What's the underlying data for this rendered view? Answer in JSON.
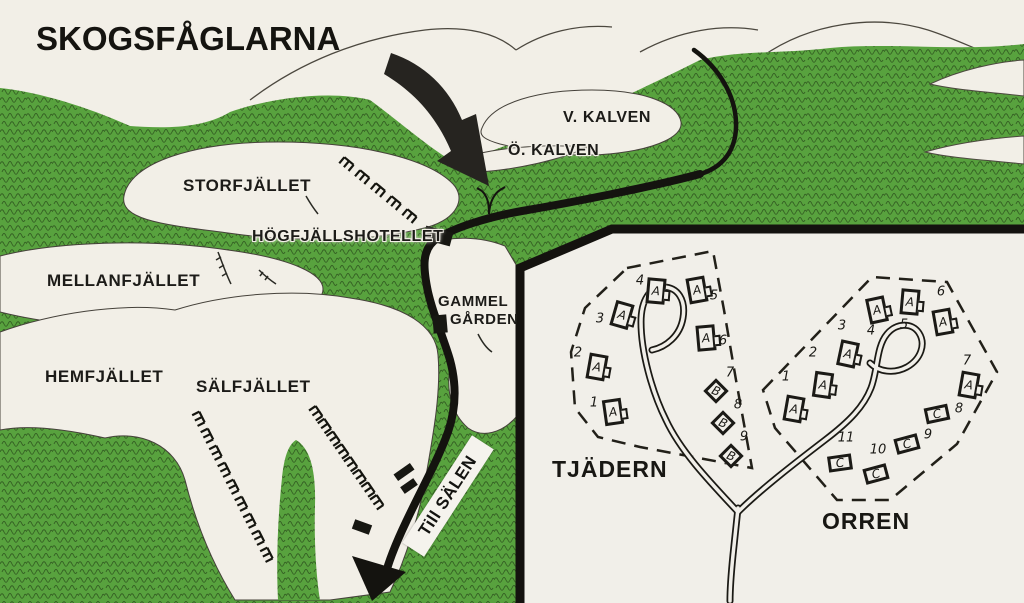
{
  "title": "SKOGSFÅGLARNA",
  "colors": {
    "forest_green": "#58a23e",
    "paper": "#f2efe7",
    "inset_paper": "#f1efe9",
    "ink": "#1c1b18"
  },
  "map_labels": {
    "storfjallet": "STORFJÄLLET",
    "v_kalven": "V. KALVEN",
    "o_kalven": "Ö. KALVEN",
    "hogfjallshotellet": "HÖGFJÄLLSHOTELLET",
    "mellanfjallet": "MELLANFJÄLLET",
    "gammel": "GAMMEL",
    "garden": "GÅRDEN",
    "hemfjallet": "HEMFJÄLLET",
    "salfjallet": "SÄLFJÄLLET",
    "till_salen": "Till SÄLEN"
  },
  "inset": {
    "areas": [
      {
        "name": "TJÄDERN",
        "cabins": [
          {
            "n": "1",
            "type": "A",
            "x": 613,
            "y": 412,
            "rot": -8,
            "nx": 594,
            "ny": 403
          },
          {
            "n": "2",
            "type": "A",
            "x": 597,
            "y": 367,
            "rot": 10,
            "nx": 578,
            "ny": 353
          },
          {
            "n": "3",
            "type": "A",
            "x": 622,
            "y": 315,
            "rot": 16,
            "nx": 600,
            "ny": 319
          },
          {
            "n": "4",
            "type": "A",
            "x": 656,
            "y": 291,
            "rot": 5,
            "nx": 640,
            "ny": 281
          },
          {
            "n": "5",
            "type": "A",
            "x": 697,
            "y": 290,
            "rot": -10,
            "nx": 714,
            "ny": 296
          },
          {
            "n": "6",
            "type": "A",
            "x": 706,
            "y": 338,
            "rot": -5,
            "nx": 723,
            "ny": 341
          },
          {
            "n": "7",
            "type": "B",
            "x": 716,
            "y": 391,
            "rot": 45,
            "nx": 730,
            "ny": 373
          },
          {
            "n": "8",
            "type": "B",
            "x": 723,
            "y": 423,
            "rot": 45,
            "nx": 738,
            "ny": 405
          },
          {
            "n": "9",
            "type": "B",
            "x": 731,
            "y": 456,
            "rot": 45,
            "nx": 744,
            "ny": 437
          }
        ]
      },
      {
        "name": "ORREN",
        "cabins": [
          {
            "n": "1",
            "type": "A",
            "x": 794,
            "y": 409,
            "rot": 10,
            "nx": 786,
            "ny": 377
          },
          {
            "n": "2",
            "type": "A",
            "x": 823,
            "y": 385,
            "rot": 8,
            "nx": 813,
            "ny": 353
          },
          {
            "n": "3",
            "type": "A",
            "x": 848,
            "y": 354,
            "rot": 12,
            "nx": 842,
            "ny": 326
          },
          {
            "n": "4",
            "type": "A",
            "x": 877,
            "y": 310,
            "rot": -12,
            "nx": 871,
            "ny": 331
          },
          {
            "n": "5",
            "type": "A",
            "x": 910,
            "y": 302,
            "rot": 5,
            "nx": 904,
            "ny": 325
          },
          {
            "n": "6",
            "type": "A",
            "x": 943,
            "y": 322,
            "rot": -10,
            "nx": 941,
            "ny": 292
          },
          {
            "n": "7",
            "type": "A",
            "x": 969,
            "y": 385,
            "rot": 10,
            "nx": 967,
            "ny": 361
          },
          {
            "n": "8",
            "type": "C",
            "x": 937,
            "y": 414,
            "rot": -12,
            "nx": 959,
            "ny": 409
          },
          {
            "n": "9",
            "type": "C",
            "x": 907,
            "y": 444,
            "rot": -15,
            "nx": 928,
            "ny": 435
          },
          {
            "n": "10",
            "type": "C",
            "x": 876,
            "y": 474,
            "rot": -15,
            "nx": 878,
            "ny": 450
          },
          {
            "n": "11",
            "type": "C",
            "x": 840,
            "y": 463,
            "rot": -8,
            "nx": 846,
            "ny": 438
          }
        ]
      }
    ]
  },
  "map_symbols": {
    "lifts": [
      {
        "name": "ski-lift-storfjallet",
        "x1": 349,
        "y1": 161,
        "x2": 412,
        "y2": 213,
        "ticks": 5
      },
      {
        "name": "ski-lift-salfjallet-west",
        "x1": 202,
        "y1": 417,
        "x2": 270,
        "y2": 553,
        "ticks": 9
      },
      {
        "name": "ski-lift-salfjallet-east",
        "x1": 319,
        "y1": 411,
        "x2": 380,
        "y2": 500,
        "ticks": 8
      }
    ]
  }
}
